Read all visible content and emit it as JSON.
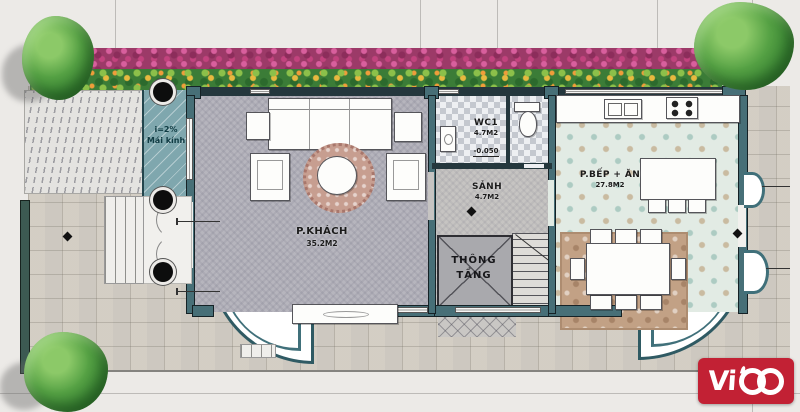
{
  "plan": {
    "rooms": {
      "living": {
        "name": "P.KHÁCH",
        "area": "35.2M2"
      },
      "hall": {
        "name": "SẢNH",
        "area": "4.7M2"
      },
      "wc": {
        "name": "WC1",
        "area": "4.7M2",
        "level": "-0.050"
      },
      "kitchen": {
        "name": "P.BẾP + ĂN",
        "area": "27.8M2"
      },
      "void": {
        "line1": "THÔNG",
        "line2": "TẦNG"
      }
    },
    "glass_roof": {
      "slope": "i=2%",
      "label": "Mái kính"
    }
  },
  "logo": {
    "name": "ViCo",
    "prefix": "Vi",
    "bg": "#c22134",
    "fg": "#ffffff"
  },
  "colors": {
    "wall_teal": "#476f77",
    "wall_dark": "#24373d",
    "glass_roof_teal": "#7fa7ae",
    "flower_magenta": "#9c3a68",
    "plant_green": "#3b7c37",
    "logo_red": "#c22134",
    "paving": "#dbd7cf",
    "living_floor": "#b6b5bd",
    "kitchen_floor": "#e2ebe4"
  }
}
